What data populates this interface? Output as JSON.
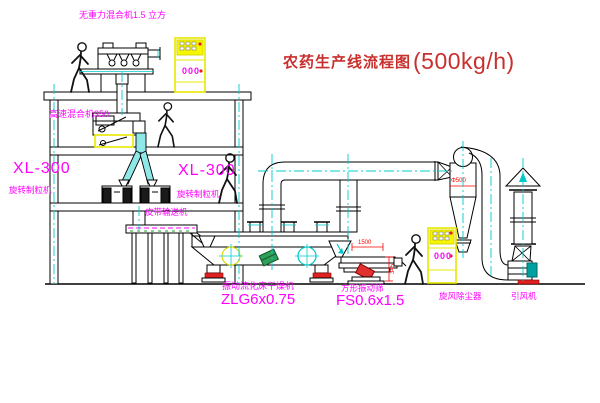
{
  "title": {
    "text_cn": "农药生产线流程图",
    "capacity": "(500kg/h)"
  },
  "equipment_labels": {
    "gravity_mixer": "无重力混合机1.5 立方",
    "high_speed_mixer": "高速混合机350",
    "granulator_left": {
      "model": "XL-300",
      "name": "旋转制粒机"
    },
    "granulator_right": {
      "model": "XL-300",
      "name": "旋转制粒机"
    },
    "belt_conveyor": "皮带输送机",
    "fluid_bed_dryer": {
      "name": "振动流化床干燥机",
      "model": "ZLG6x0.75"
    },
    "square_sieve": {
      "name": "方形振动筛",
      "model": "FS0.6x1.5"
    },
    "cyclone": "旋风除尘器",
    "induced_draft_fan": "引风机"
  },
  "dimensions": {
    "cyclone_diameter": "Φ500",
    "sieve_length": "1500",
    "sieve_height": "345"
  },
  "control_panels": {
    "panel_upper": {
      "display": "000"
    },
    "panel_lower": {
      "display": "000"
    }
  },
  "colors": {
    "label_magenta": "#FF00FF",
    "title_red": "#C8302E",
    "dimension_red": "#FF0000",
    "centerline_cyan": "#00CCCC",
    "cabinet_yellow": "#EDED00",
    "motor_green": "#2FA05A",
    "motor_teal": "#00A0A0",
    "line_black": "#000000"
  }
}
